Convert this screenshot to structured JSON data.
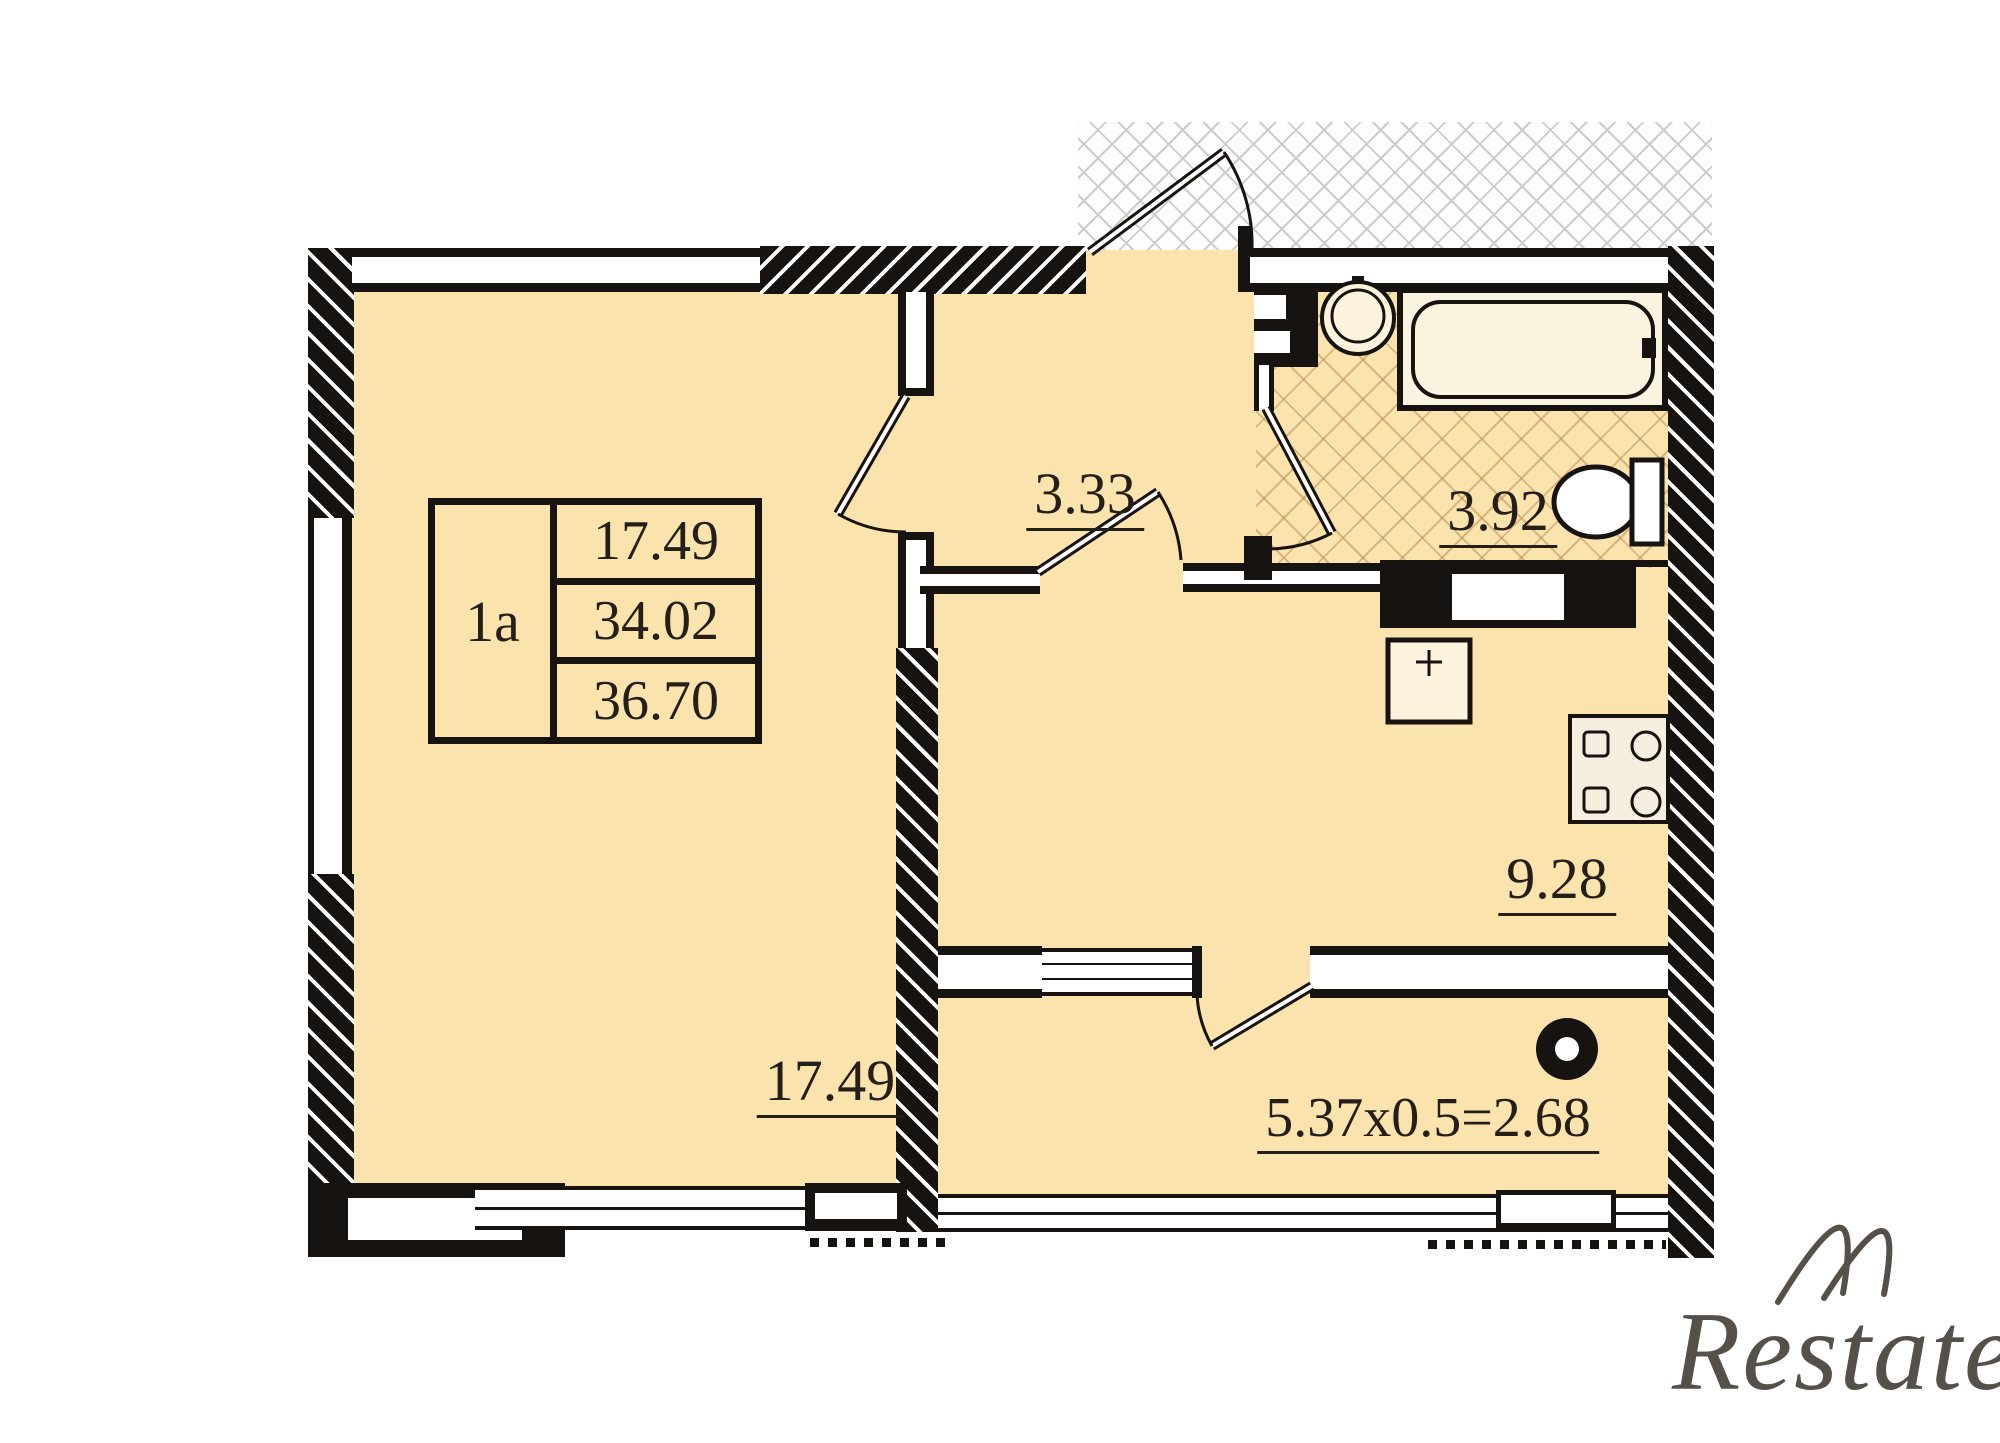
{
  "plan": {
    "info_box": {
      "unit_label": "1a",
      "values": [
        "17.49",
        "34.02",
        "36.70"
      ]
    },
    "rooms": {
      "hall_area": "3.33",
      "bathroom_area": "3.92",
      "kitchen_area": "9.28",
      "living_area": "17.49",
      "balcony_area": "5.37x0.5=2.68"
    },
    "watermark": "Restate",
    "colors": {
      "wall": "#171310",
      "floor": "#fbe3ae",
      "tile_line": "#b99055",
      "crosshatch_line": "#cccccc"
    }
  }
}
